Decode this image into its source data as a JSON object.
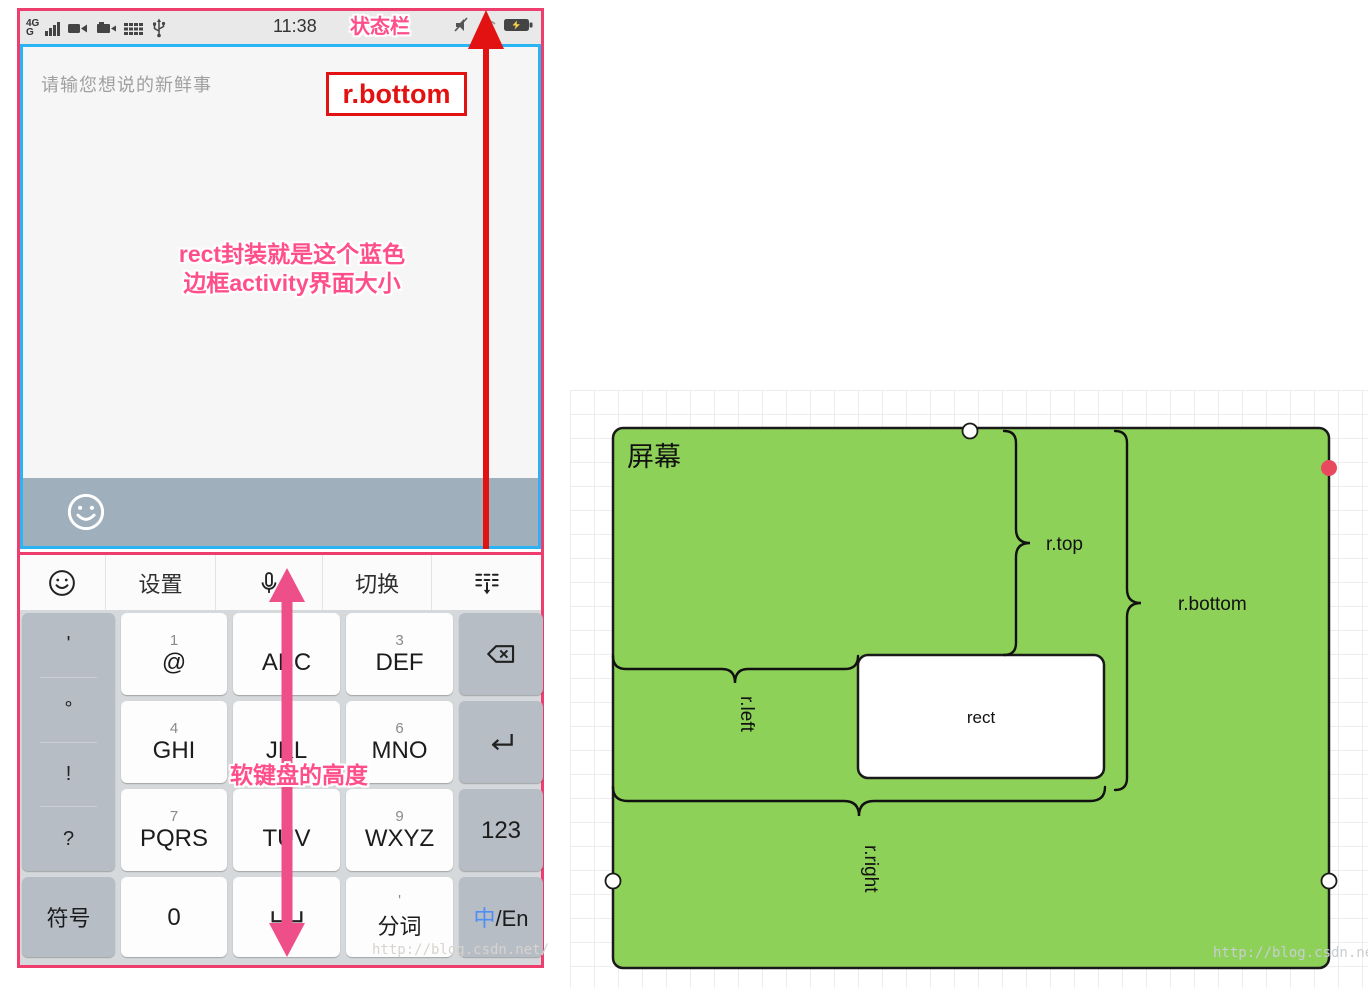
{
  "phone": {
    "status_bar": {
      "sim1": "4G",
      "sim2": "G",
      "time": "11:38"
    },
    "activity": {
      "placeholder": "请输您想说的新鲜事"
    },
    "keyboard": {
      "toolbar": {
        "settings": "设置",
        "switch": "切换"
      },
      "side_symbols": [
        "'",
        "°",
        "!",
        "?"
      ],
      "keys": [
        {
          "sub": "1",
          "main": "@"
        },
        {
          "sub": "2",
          "main": "ABC"
        },
        {
          "sub": "3",
          "main": "DEF"
        },
        {
          "sub": "4",
          "main": "GHI"
        },
        {
          "sub": "5",
          "main": "JKL"
        },
        {
          "sub": "6",
          "main": "MNO"
        },
        {
          "sub": "7",
          "main": "PQRS"
        },
        {
          "sub": "8",
          "main": "TUV"
        },
        {
          "sub": "9",
          "main": "WXYZ"
        }
      ],
      "right_col": {
        "numbers": "123"
      },
      "bottom_row": {
        "symbols": "符号",
        "zero": "0",
        "word_seg_sub": "'",
        "word_seg": "分词",
        "lang_zh": "中",
        "lang_en": "/En"
      }
    }
  },
  "annotations": {
    "status_bar_label": "状态栏",
    "r_bottom_box": "r.bottom",
    "rect_note_line1": "rect封装就是这个蓝色",
    "rect_note_line2": "边框activity界面大小",
    "keyboard_height": "软键盘的高度"
  },
  "diagram": {
    "screen_label": "屏幕",
    "rect_label": "rect",
    "r_top": "r.top",
    "r_bottom": "r.bottom",
    "r_left": "r.left",
    "r_right": "r.right"
  },
  "watermark": {
    "left": "http://blog.csdn.net/",
    "right": "http://blog.csdn.net/"
  },
  "colors": {
    "pink_border": "#ee3e6e",
    "blue_border": "#2bb4f4",
    "red": "#e31212",
    "annotation_pink": "#ff4f8b",
    "green": "#8ed159",
    "key_gray": "#b6bdc5"
  }
}
